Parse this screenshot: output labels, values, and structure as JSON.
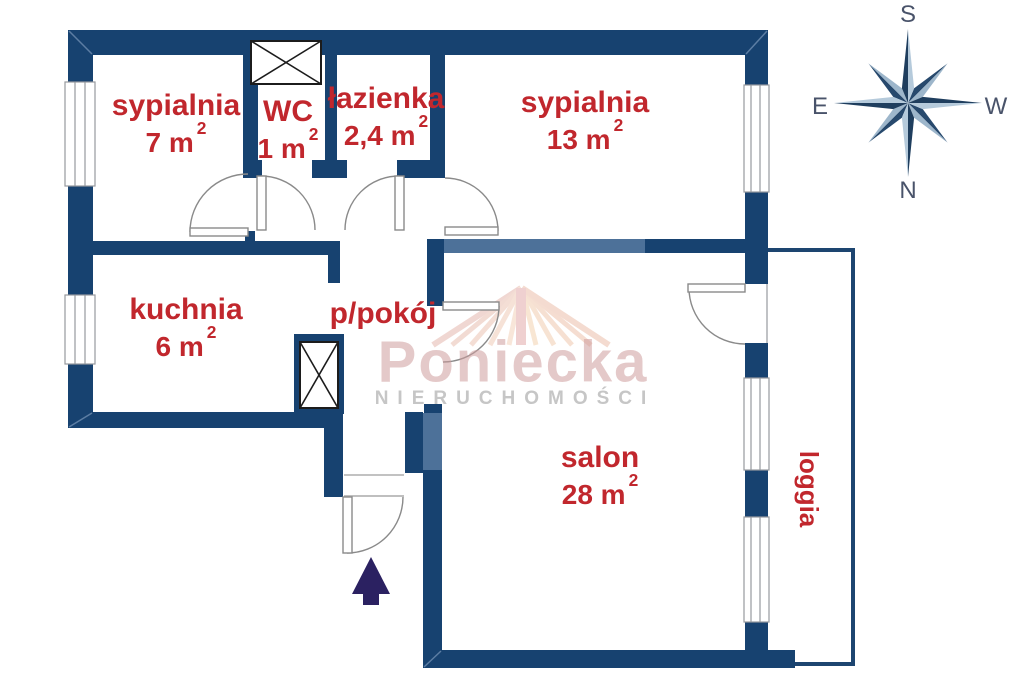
{
  "plan": {
    "rooms": [
      {
        "name": "sypialnia",
        "area": "7 m",
        "sup": "2"
      },
      {
        "name": "WC",
        "area": "1 m",
        "sup": "2"
      },
      {
        "name": "łazienka",
        "area": "2,4 m",
        "sup": "2"
      },
      {
        "name": "sypialnia",
        "area": "13 m",
        "sup": "2"
      },
      {
        "name": "kuchnia",
        "area": "6 m",
        "sup": "2"
      },
      {
        "name": "p/pokój"
      },
      {
        "name": "salon",
        "area": "28 m",
        "sup": "2"
      },
      {
        "name": "loggia"
      }
    ],
    "colors": {
      "wall": "#174270",
      "wall_light": "#4d7199",
      "label": "#c1272d",
      "arrow": "#2b2161",
      "watermark": "#cf9d9d"
    }
  },
  "compass": {
    "top": "S",
    "bottom": "N",
    "left": "E",
    "right": "W"
  },
  "watermark": {
    "brand": "Poniecka",
    "subtitle": "NIERUCHOMOŚCI"
  }
}
